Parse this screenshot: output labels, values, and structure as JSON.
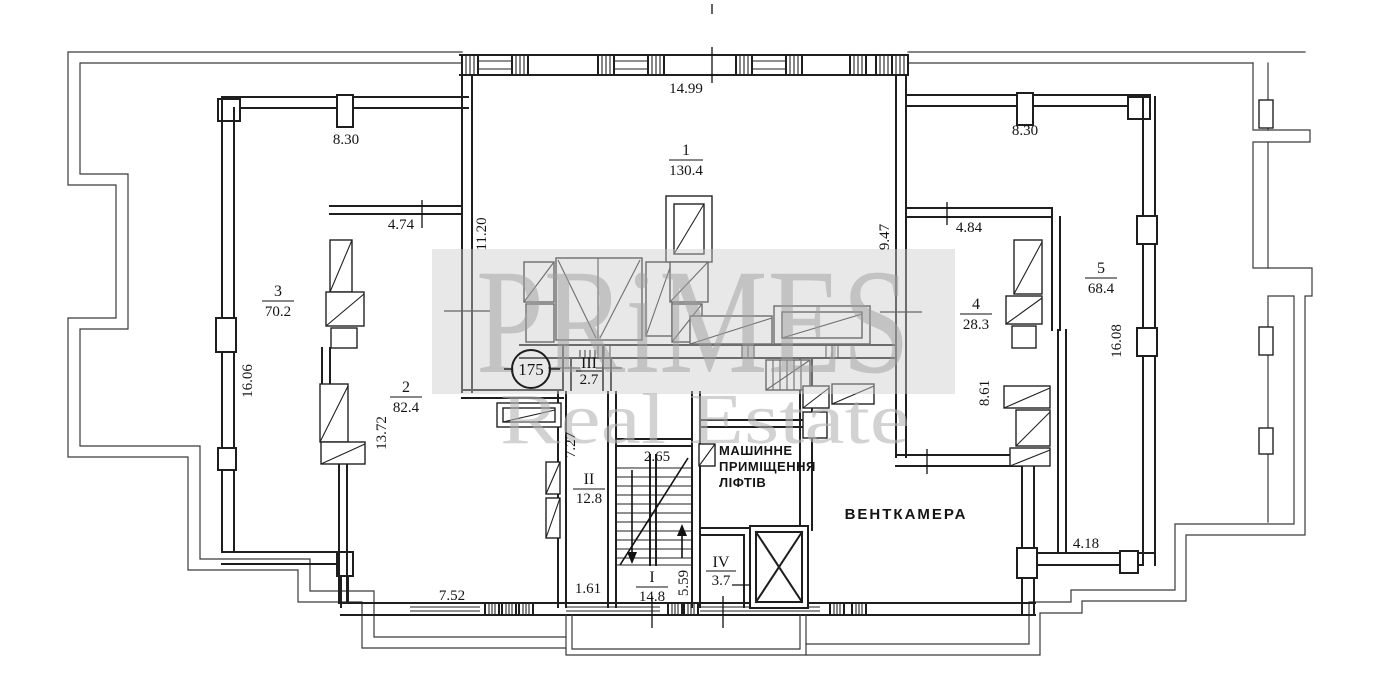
{
  "watermark": {
    "brand": "PRiMES",
    "subtitle": "Real Estate"
  },
  "plan": {
    "badge": "175",
    "rooms": [
      {
        "id": "1",
        "area": "130.4"
      },
      {
        "id": "2",
        "area": "82.4"
      },
      {
        "id": "3",
        "area": "70.2"
      },
      {
        "id": "4",
        "area": "28.3"
      },
      {
        "id": "5",
        "area": "68.4"
      },
      {
        "id": "I",
        "area": "14.8"
      },
      {
        "id": "II",
        "area": "12.8"
      },
      {
        "id": "III",
        "area": "2.7"
      },
      {
        "id": "IV",
        "area": "3.7"
      }
    ],
    "named": {
      "machine1": "МАШИННЕ",
      "machine2": "ПРИМІЩЕННЯ",
      "machine3": "ЛІФТІВ",
      "vent": "ВЕНТКАМЕРА"
    },
    "dims": {
      "top_width": "14.99",
      "left_wing_top": "8.30",
      "right_wing_top": "8.30",
      "room2_top": "4.74",
      "hall_left_height": "11.20",
      "hall_right_height": "9.47",
      "room4_top": "4.84",
      "left_wall_height": "16.06",
      "right_wall_height": "16.08",
      "room2_height": "13.72",
      "room4_height": "8.61",
      "corridor_height": "7.27",
      "stair_landing": "2.65",
      "stair_flight": "5.59",
      "corridor_door": "1.61",
      "left_wing_bottom": "7.52",
      "vent_terrace": "4.18"
    }
  }
}
